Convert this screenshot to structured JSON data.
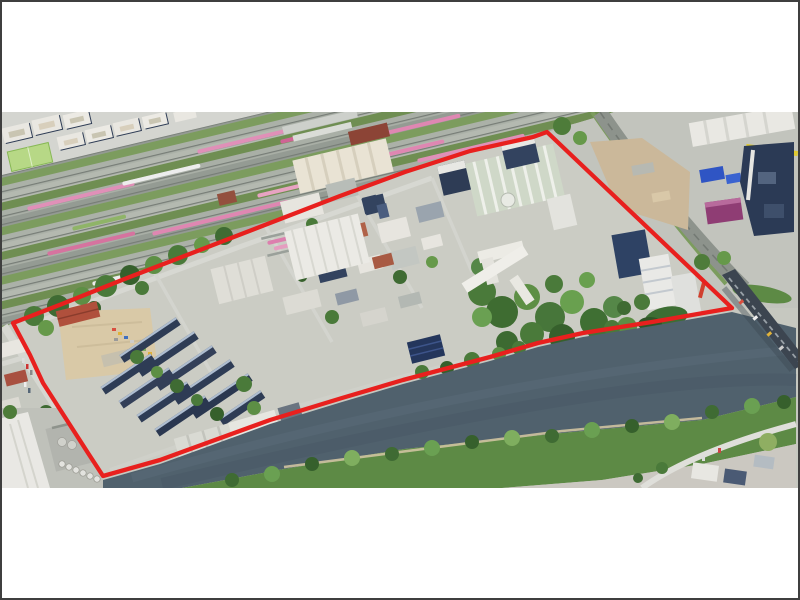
{
  "page": {
    "background": "#ffffff",
    "frame_color": "#3f3f3f",
    "content": "single aerial photograph centered vertically on a white page, no visible text"
  },
  "figure": {
    "kind": "oblique aerial photograph",
    "subject": "riverside industrial and harbour district between a railway marshalling yard and a river",
    "annotation": "red polygon outlining the site boundary",
    "photo_area_px": {
      "left": 2,
      "top": 112,
      "width": 796,
      "height": 376
    }
  },
  "boundary": {
    "name": "site-boundary",
    "color": "#e8201e",
    "stroke_width_px": 4.3,
    "vertices_px": [
      [
        547,
        132
      ],
      [
        533,
        137
      ],
      [
        470,
        151
      ],
      [
        403,
        172
      ],
      [
        340,
        196
      ],
      [
        270,
        223
      ],
      [
        200,
        250
      ],
      [
        122,
        280
      ],
      [
        62,
        304
      ],
      [
        13,
        323
      ],
      [
        30,
        355
      ],
      [
        43,
        383
      ],
      [
        70,
        425
      ],
      [
        88,
        453
      ],
      [
        103,
        476
      ],
      [
        160,
        460
      ],
      [
        270,
        420
      ],
      [
        342,
        398
      ],
      [
        403,
        380
      ],
      [
        490,
        357
      ],
      [
        538,
        343
      ],
      [
        583,
        333
      ],
      [
        652,
        322
      ],
      [
        732,
        308
      ]
    ]
  },
  "landmarks": [
    {
      "name": "railway-marshalling-yard",
      "position": "north-west",
      "detail": "many parallel tracks with pink and white train consists and grass strips"
    },
    {
      "name": "residential-perimeter-blocks",
      "position": "top-left corner",
      "detail": "white apartment blocks with courtyards and a green sports field"
    },
    {
      "name": "station-platform-canopies",
      "position": "top centre"
    },
    {
      "name": "rail-maintenance-halls",
      "position": "north of boundary, cream ribbed roofs"
    },
    {
      "name": "water-treatment-complex",
      "position": "inside site near north corner",
      "detail": "pale ribbed tank field with white dome"
    },
    {
      "name": "vacant-sandy-lot",
      "position": "west part of site"
    },
    {
      "name": "terraced-row-houses",
      "position": "west part of site",
      "detail": "dark roofs with solar panels, diagonal rows"
    },
    {
      "name": "industrial-halls",
      "position": "centre of site, white ribbed warehouse"
    },
    {
      "name": "riverside-park",
      "position": "east part of site, dense trees"
    },
    {
      "name": "high-rise-towers",
      "position": "east corner of site near bridge"
    },
    {
      "name": "river",
      "position": "south-east, flowing lower-left to upper-right"
    },
    {
      "name": "road-bridge",
      "position": "east, crossing the river diagonally"
    },
    {
      "name": "south-bank-park",
      "position": "far bank covered with trees"
    },
    {
      "name": "port-concrete-plant-silos",
      "position": "south-west corner"
    },
    {
      "name": "power-plant-purple-building",
      "position": "north-east industrial zone"
    }
  ],
  "palette": {
    "urban_base": "#c6c8c0",
    "site_base": "#cbccc4",
    "river": "#50616d",
    "vegetation_dark": "#3f6b33",
    "vegetation_light": "#6aa052",
    "south_bank": "#5d8a45",
    "railway_grass": "#7c9c5e",
    "train_pink": "#df8ab2",
    "sand_lot": "#d9c9a7",
    "bridge": "#3c4550",
    "purple_building": "#8f3d74",
    "navy_roof": "#2e3c55",
    "city_block": "#e9e7e1"
  }
}
